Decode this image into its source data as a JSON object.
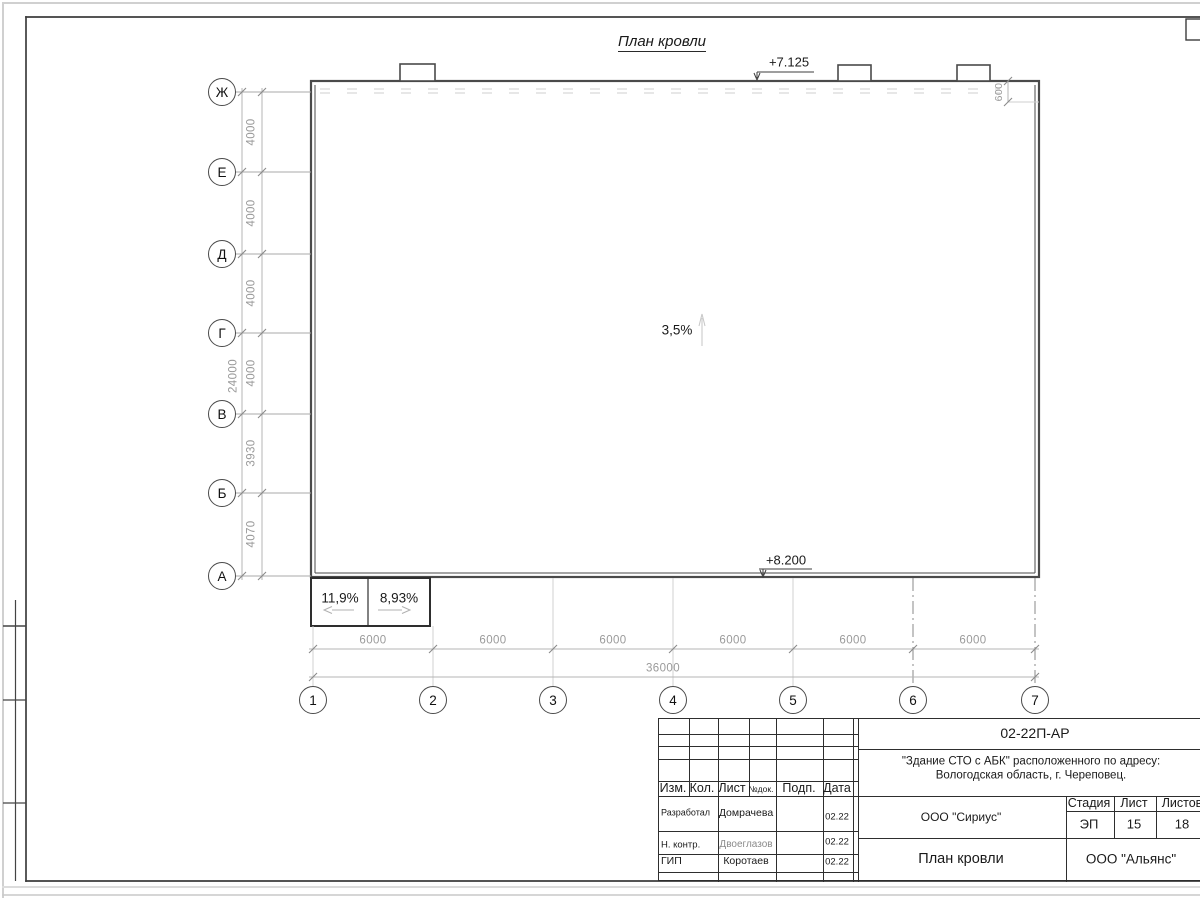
{
  "page": {
    "drawing_title": "План кровли"
  },
  "plan": {
    "slope_center": "3,5%",
    "slope_box_left": "11,9%",
    "slope_box_right": "8,93%",
    "elev_top": "+7.125",
    "elev_bottom": "+8.200",
    "parapet_dim": "600",
    "axes_rows": [
      "Ж",
      "Е",
      "Д",
      "Г",
      "В",
      "Б",
      "А"
    ],
    "axes_cols": [
      "1",
      "2",
      "3",
      "4",
      "5",
      "6",
      "7"
    ],
    "row_dims": [
      "4000",
      "4000",
      "4000",
      "4000",
      "3930",
      "4070"
    ],
    "row_total": "24000",
    "col_dims": [
      "6000",
      "6000",
      "6000",
      "6000",
      "6000",
      "6000"
    ],
    "col_total": "36000"
  },
  "titleblock": {
    "doc_code": "02-22П-АР",
    "project_line1": "\"Здание СТО с АБК\" расположенного по адресу:",
    "project_line2": "Вологодская область, г. Череповец.",
    "org_design": "ООО \"Сириус\"",
    "org_customer": "ООО \"Альянс\"",
    "sheet_title": "План кровли",
    "col_izm": "Изм.",
    "col_kol": "Кол.",
    "col_list": "Лист",
    "col_ndok": "№док.",
    "col_podp": "Подп.",
    "col_data": "Дата",
    "col_stage": "Стадия",
    "col_sheet": "Лист",
    "col_sheets": "Листов",
    "stage_value": "ЭП",
    "sheet_value": "15",
    "sheets_value": "18",
    "roles": [
      {
        "role": "Разработал",
        "name": "Домрачева",
        "date": "02.22"
      },
      {
        "role": "Н. контр.",
        "name": "Двоеглазов",
        "date": "02.22"
      },
      {
        "role": "ГИП",
        "name": "Коротаев",
        "date": "02.22"
      }
    ]
  },
  "colors": {
    "frame": "#3d3d3d",
    "drawing_line": "#4a4a4a",
    "dim_line": "#b0b0b0",
    "dim_text": "#9a9a9a",
    "text": "#1a1a1a"
  }
}
